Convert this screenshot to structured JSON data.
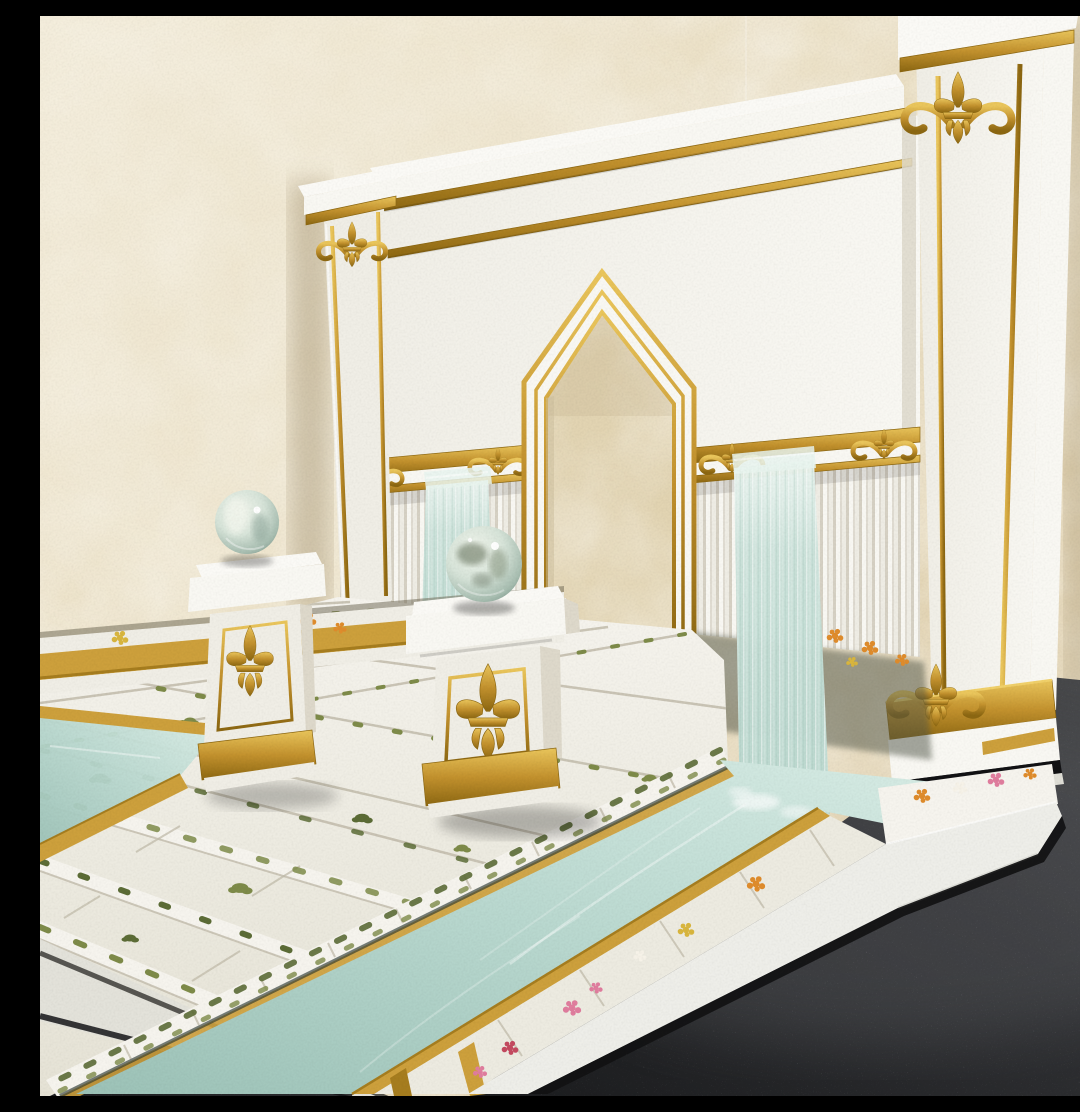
{
  "scene": {
    "description": "Photograph of a handmade miniature diorama: a white and gold palace garden with a pointed gothic archway, two white pedestals topped with glass orbs, two pale aqua waterfalls spilling over a slatted balustrade, a mossy white stone tile courtyard with steps, and an aqua water channel edged in gold wood with flower planters, displayed against beige marbled wallpaper on a dark speckled table",
    "objects": {
      "wallpaper": "beige marbled wallpaper backdrop",
      "table": "dark speckled table surface",
      "back_wall": "white back wall with double gold trim lines and white coping",
      "arch": "pointed archway with double gold border, open to the wallpaper behind",
      "left_pillar": "white pillar with gold scroll capital and gold edge lines",
      "right_pillar": "tall white corner pillar with gold fleur-de-lis crest, gold edge lines and ornate gold base",
      "balustrade": "white slatted balustrade with gold rail and gold scroll ornaments",
      "waterfall_narrow": "narrow pale waterfall left of the arch",
      "waterfall_wide": "wide pale waterfall right of the arch feeding the channel",
      "floor": "white stone tile courtyard with moss growing in the joints",
      "steps": "three shallow white stone steps descending to the front left",
      "channel": "aqua water channel crossing the front, edged with gold wooden rails",
      "pedestal_left": "small white pedestal with gold fleur-de-lis holding a glass orb",
      "pedestal_center": "white pedestal with gold frame and fleur-de-lis holding a glass orb",
      "planter_rear": "rear trough planter with grasses and orange marigolds",
      "planter_front": "front white trough planter with greenery, pink, red and orange blooms",
      "flower_bed_right": "flower bed at the right pillar base",
      "plants": "dark green spiky foliage plants beside the waterfalls",
      "orbs": "two pale green glass marbles"
    }
  },
  "palette": {
    "wallpaper_base": "#e7dabb",
    "wallpaper_light": "#f3ecd9",
    "wallpaper_dark": "#d7c49e",
    "arch_view": "#e2d4b2",
    "wall_white": "#f0eee6",
    "wall_bright": "#f9f8f3",
    "wall_shadow": "#ded9cb",
    "coping_top": "#fbfaf6",
    "gold": "#c3922e",
    "gold_light": "#eac65c",
    "gold_dark": "#8c6712",
    "mustard": "#cda03c",
    "mustard_dark": "#a67d1f",
    "fence_base": "#efede5",
    "slat_shadow": "#d6d1c4",
    "fall": "#cbe2da",
    "fall_light": "#e9f4ef",
    "water": "#b9d8cf",
    "water_light": "#d9ede6",
    "water_deep": "#9cc2b7",
    "tile": "#edebe1",
    "tile_light": "#f6f4ee",
    "tile_gap": "#c2bcab",
    "moss": "#7e8b49",
    "moss_dark": "#5c6c36",
    "leaf_dark": "#3f5238",
    "leaf_olive": "#6e7f52",
    "grass_green": "#9aa356",
    "grass_dry": "#b7a765",
    "flower_orange": "#df8c2c",
    "flower_yellow": "#d9b63e",
    "flower_pink": "#e07d9e",
    "flower_red": "#c44a60",
    "flower_white": "#f6f2e8",
    "orb_light": "#f1f5ec",
    "orb_mid": "#d6e3d8",
    "orb_edge": "#a7bdb0",
    "orb_dark": "#87a094",
    "table_dark": "#1b1c1e",
    "table_mid": "#303134",
    "table_light": "#4b4c4e",
    "black_trim": "#121214",
    "shadow_warm": "#a3926f",
    "soil": "#6a6450"
  }
}
